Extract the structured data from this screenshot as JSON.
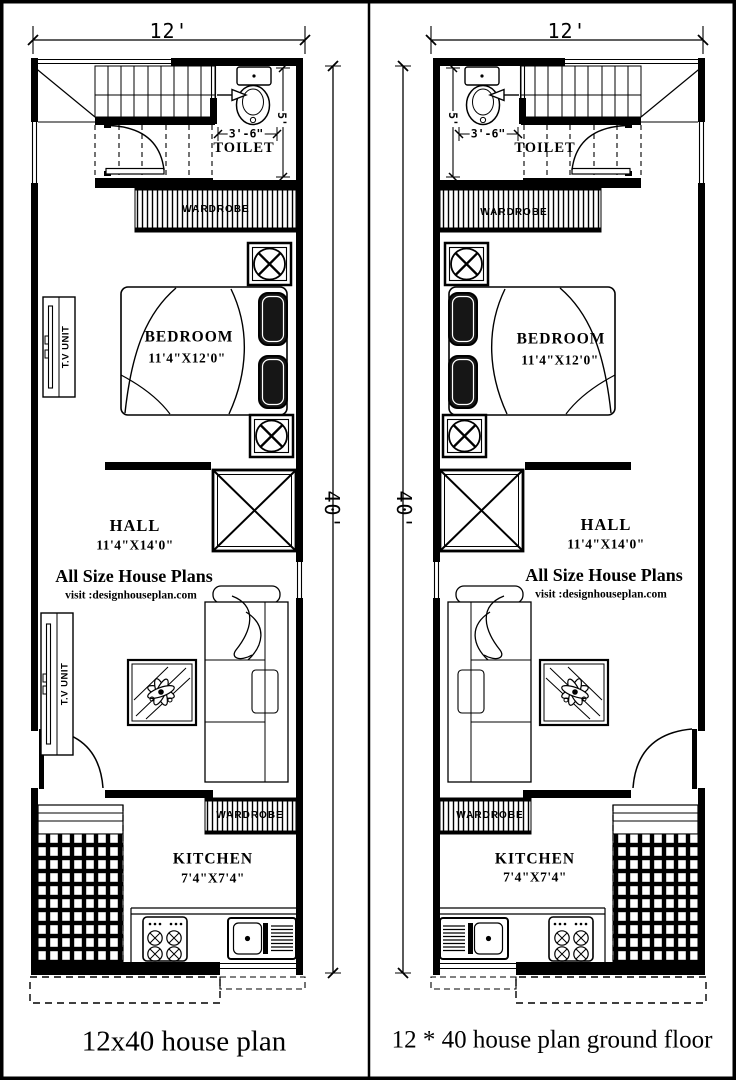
{
  "captions": {
    "left": "12x40 house plan",
    "right": "12 * 40 house plan ground floor"
  },
  "labels": {
    "overall_width": "12'",
    "overall_height": "40'",
    "toilet_width": "3'-6\"",
    "toilet_depth": "5'",
    "toilet": "TOILET",
    "wardrobe": "WARDROBE",
    "bedroom": "BEDROOM",
    "bedroom_size": "11'4\"X12'0\"",
    "tv_unit": "T.V UNIT",
    "hall": "HALL",
    "hall_size": "11'4\"X14'0\"",
    "watermark_title": "All Size House Plans",
    "watermark_sub": "visit :designhouseplan.com",
    "kitchen": "KITCHEN",
    "kitchen_size": "7'4\"X7'4\""
  },
  "colors": {
    "ink": "#000000",
    "paper": "#ffffff"
  }
}
